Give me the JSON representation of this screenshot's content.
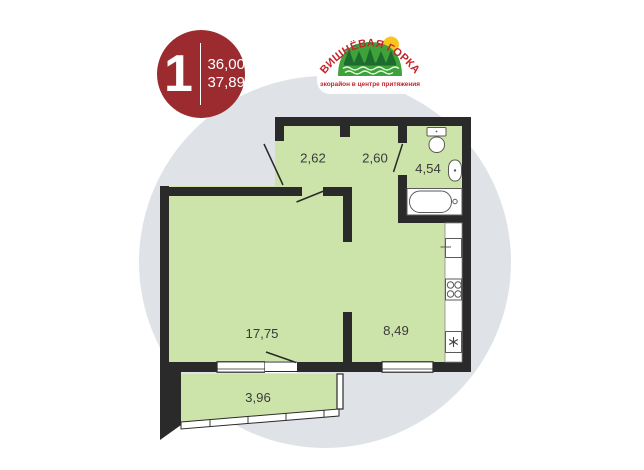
{
  "badge": {
    "rooms_count": "1",
    "area_primary": "36,00",
    "area_secondary": "37,89",
    "bg_color": "#9b2b2e"
  },
  "logo": {
    "title": "ВИШНЁВАЯ ГОРКА",
    "tagline": "экорайон в центре притяжения",
    "title_color": "#c4252b",
    "hill_color": "#3ea23a",
    "tree_color": "#1e6b2f",
    "sun_color": "#f6c51e"
  },
  "plan": {
    "wall_color": "#2a2a2a",
    "room_fill": "#cce3a9",
    "background_circle_color": "#dfe3e8",
    "rooms": [
      {
        "name": "hallway",
        "label": "2,62"
      },
      {
        "name": "corridor",
        "label": "2,60"
      },
      {
        "name": "bathroom",
        "label": "4,54"
      },
      {
        "name": "living-room",
        "label": "17,75"
      },
      {
        "name": "kitchen",
        "label": "8,49"
      },
      {
        "name": "balcony",
        "label": "3,96"
      }
    ],
    "fixtures": [
      "bathtub",
      "toilet",
      "washbasin",
      "kitchen-sink",
      "stove",
      "refrigerator"
    ]
  }
}
